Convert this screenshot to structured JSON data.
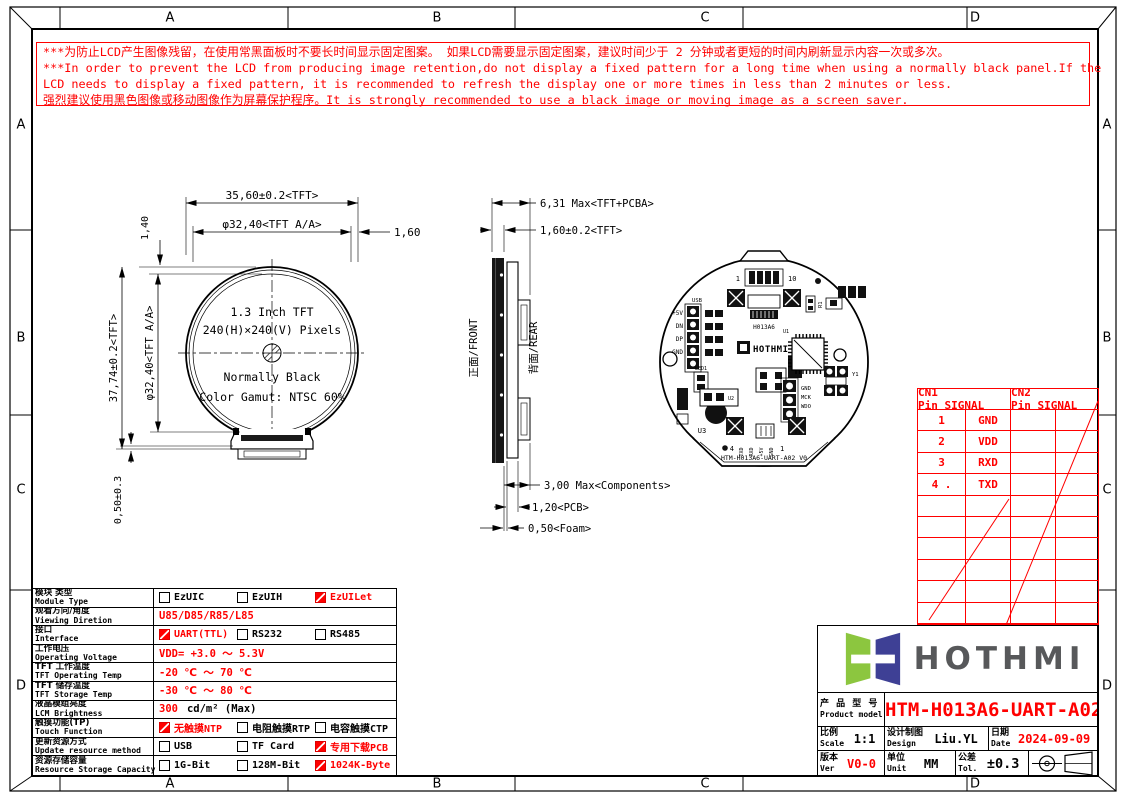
{
  "colors": {
    "red": "#ff0000",
    "logo_green": "#8cc63f",
    "logo_indigo": "#3e4095",
    "brand_gray": "#57585a"
  },
  "border": {
    "top": [
      "A",
      "B",
      "C",
      "D"
    ],
    "bottom": [
      "A",
      "B",
      "C",
      "D"
    ],
    "left": [
      "A",
      "B",
      "C",
      "D"
    ],
    "right": [
      "A",
      "B",
      "C",
      "D"
    ]
  },
  "warning": {
    "lines": [
      "***为防止LCD产生图像残留，在使用常黑面板时不要长时间显示固定图案。 如果LCD需要显示固定图案，建议时间少于 2 分钟或者更短的时间内刷新显示内容一次或多次。",
      "***In order to prevent the LCD from producing image retention,do not display a fixed pattern for a long time when using a normally black panel.If the",
      " LCD needs to display a fixed pattern,  it is recommended to refresh the display one or more times in less than 2 minutes or  less.",
      "强烈建议使用黑色图像或移动图像作为屏幕保护程序。It is strongly recommended to use a black image or moving image as a screen saver."
    ]
  },
  "front_view": {
    "dim_width_top": "35,60±0.2<TFT>",
    "dim_aa_width": "φ32,40<TFT A/A>",
    "dim_right_gap": "1,60",
    "dim_top_gap": "1,40",
    "dim_height_left": "37,74±0.2<TFT>",
    "dim_aa_height": "φ32,40<TFT A/A>",
    "dim_bottom_gap": "0,50±0.3",
    "line1": "1.3 Inch TFT",
    "line2": "240(H)×240(V) Pixels",
    "line3": "Normally Black",
    "line4": "Color Gamut: NTSC 60%"
  },
  "side_view": {
    "dim_total": "6,31 Max<TFT+PCBA>",
    "dim_tft": "1,60±0.2<TFT>",
    "dim_components": "3,00 Max<Components>",
    "dim_pcb": "1,20<PCB>",
    "dim_foam": "0,50<Foam>",
    "front_label": "正面/FRONT",
    "rear_label": "背面/REAR"
  },
  "rear_view": {
    "pin1": "1",
    "pin10": "10",
    "usb": "USB",
    "p5v": "+5V",
    "dn": "DN",
    "dp": "DP",
    "gnd": "GND",
    "led1": "LED1",
    "u1": "U1",
    "u2": "U2",
    "u3": "U3",
    "r1": "R1",
    "y1": "Y1",
    "h013a6": "H013A6",
    "brand": "HOTHMI",
    "gnd_r": "GND",
    "mck": "MCK",
    "wdo": "WDO",
    "pin4": "4",
    "pin1b": "1",
    "txd": "TXD",
    "rxd": "RXD",
    "p5vb": "+5V",
    "gndb": "GND",
    "board_text": "HTM-H013A6-UART-A02 V0"
  },
  "pin_table": {
    "cn1_header": "CN1 Pin_SIGNAL",
    "cn2_header": "CN2 Pin_SIGNAL",
    "rows": [
      [
        "1",
        "GND"
      ],
      [
        "2",
        "VDD"
      ],
      [
        "3",
        "RXD"
      ],
      [
        "4 .",
        "TXD"
      ]
    ]
  },
  "spec_table": {
    "rows": [
      {
        "cn": "模块 类型",
        "en": "Module Type",
        "options": [
          {
            "t": "EzUIC",
            "c": false
          },
          {
            "t": "EzUIH",
            "c": false
          },
          {
            "t": "EzUILet",
            "c": true
          }
        ]
      },
      {
        "cn": "观看方向/角度",
        "en": "Viewing Diretion",
        "value": "U85/D85/R85/L85"
      },
      {
        "cn": "接口",
        "en": "Interface",
        "options": [
          {
            "t": "UART(TTL)",
            "c": true
          },
          {
            "t": "RS232",
            "c": false
          },
          {
            "t": "RS485",
            "c": false
          }
        ]
      },
      {
        "cn": "工作电压",
        "en": "Operating Voltage",
        "value": "VDD= +3.0 ～ 5.3V"
      },
      {
        "cn": "TFT 工作温度",
        "en": "TFT Operating Temp",
        "value": "-20 ℃ ～ 70 ℃"
      },
      {
        "cn": "TFT 储存温度",
        "en": "TFT Storage Temp",
        "value": "-30 ℃ ～ 80 ℃"
      },
      {
        "cn": "液晶模组亮度",
        "en": "LCM Brightness",
        "value_red": "300",
        "value_black": "cd/m² (Max)"
      },
      {
        "cn": "触摸功能(TP)",
        "en": "Touch Function",
        "options": [
          {
            "t": "无触摸NTP",
            "c": true
          },
          {
            "t": "电阻触摸RTP",
            "c": false
          },
          {
            "t": "电容触摸CTP",
            "c": false
          }
        ]
      },
      {
        "cn": "更新资源方式",
        "en": "Update resource method",
        "options": [
          {
            "t": "USB",
            "c": false
          },
          {
            "t": "TF Card",
            "c": false
          },
          {
            "t": "专用下载PCB",
            "c": true
          }
        ]
      },
      {
        "cn": "资源存储容量",
        "en": "Resource Storage Capacity",
        "options": [
          {
            "t": "1G-Bit",
            "c": false
          },
          {
            "t": "128M-Bit",
            "c": false
          },
          {
            "t": "1024K-Byte",
            "c": true
          }
        ]
      }
    ]
  },
  "title_block": {
    "brand": "HOTHMI",
    "product_label_cn": "产 品 型 号",
    "product_label_en": "Product model",
    "product_model": "HTM-H013A6-UART-A02",
    "scale_cn": "比例",
    "scale_en": "Scale",
    "scale_value": "1:1",
    "design_cn": "设计制图",
    "design_en": "Design",
    "design_value": "Liu.YL",
    "date_cn": "日期",
    "date_en": "Date",
    "date_value": "2024-09-09",
    "ver_cn": "版本",
    "ver_en": "Ver",
    "ver_value": "V0-0",
    "unit_cn": "单位",
    "unit_en": "Unit",
    "unit_value": "MM",
    "tol_cn": "公差",
    "tol_en": "Tol.",
    "tol_value": "±0.3"
  }
}
